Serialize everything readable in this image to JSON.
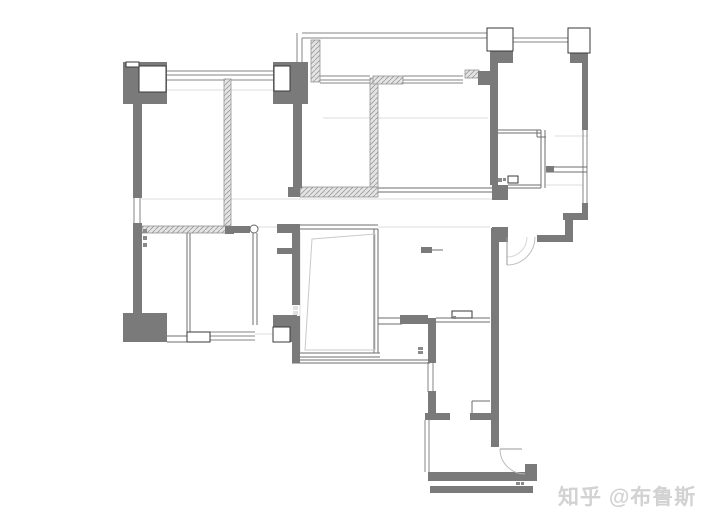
{
  "watermark": {
    "text": "知乎 @布鲁斯",
    "color": "#d2d2d2"
  },
  "canvas": {
    "width": 720,
    "height": 525,
    "background": "#ffffff"
  },
  "palette": {
    "wall": "#7a7a7a",
    "wall_outline": "#3a3a3a",
    "thin_wall": "#6e6e6e",
    "window": "#868686",
    "faint": "#dedede",
    "hatch_line": "#9a9a9a",
    "hatch_bg": "#e4e4e4",
    "arc": "#bbbbbb",
    "arc_light": "#d6d6d6",
    "furniture": "#c9c9c9",
    "mark": "#8a8a8a",
    "mark_light": "#e0e0e0"
  },
  "floorplan": {
    "faint_lines": [
      [
        142,
        199,
        492,
        199
      ],
      [
        142,
        227,
        298,
        227
      ],
      [
        378,
        227,
        490,
        227
      ],
      [
        167,
        90,
        273,
        90
      ],
      [
        323,
        118,
        488,
        118
      ],
      [
        546,
        185,
        583,
        185
      ],
      [
        555,
        136,
        588,
        136
      ],
      [
        300,
        232,
        300,
        352
      ],
      [
        255,
        334,
        273,
        334
      ]
    ],
    "window_lines": [
      [
        167,
        71,
        273,
        71
      ],
      [
        167,
        75,
        273,
        75
      ],
      [
        167,
        80,
        273,
        80
      ],
      [
        302,
        33,
        487,
        33
      ],
      [
        302,
        38,
        487,
        38
      ],
      [
        320,
        76,
        370,
        76
      ],
      [
        320,
        80,
        370,
        80
      ],
      [
        320,
        83,
        370,
        83
      ],
      [
        403,
        76,
        463,
        76
      ],
      [
        403,
        80,
        463,
        80
      ],
      [
        403,
        83,
        463,
        83
      ],
      [
        513,
        38,
        568,
        38
      ],
      [
        513,
        42,
        568,
        42
      ],
      [
        583,
        130,
        583,
        203
      ],
      [
        587,
        130,
        587,
        203
      ],
      [
        134,
        198,
        134,
        223
      ],
      [
        140,
        198,
        140,
        223
      ],
      [
        210,
        332,
        255,
        332
      ],
      [
        210,
        336,
        255,
        336
      ],
      [
        210,
        340,
        255,
        340
      ],
      [
        428,
        362,
        428,
        392
      ],
      [
        433,
        362,
        433,
        392
      ],
      [
        425,
        420,
        425,
        472
      ],
      [
        429,
        420,
        429,
        472
      ],
      [
        297,
        33,
        297,
        66
      ],
      [
        302,
        38,
        302,
        66
      ]
    ],
    "thin_lines": [
      [
        378,
        188,
        492,
        188
      ],
      [
        378,
        192,
        492,
        192
      ],
      [
        300,
        225,
        378,
        225
      ],
      [
        300,
        229,
        378,
        229
      ],
      [
        187,
        233,
        187,
        335
      ],
      [
        190,
        233,
        190,
        335
      ],
      [
        253,
        233,
        253,
        325
      ],
      [
        257,
        233,
        257,
        325
      ],
      [
        167,
        336,
        187,
        336
      ],
      [
        167,
        342,
        187,
        342
      ],
      [
        378,
        318,
        402,
        318
      ],
      [
        378,
        324,
        402,
        324
      ],
      [
        436,
        318,
        490,
        318
      ],
      [
        436,
        322,
        490,
        322
      ],
      [
        297,
        353,
        380,
        353
      ],
      [
        297,
        357,
        380,
        357
      ],
      [
        292,
        360,
        430,
        360
      ],
      [
        292,
        363,
        430,
        363
      ],
      [
        498,
        130,
        541,
        130
      ],
      [
        498,
        133,
        541,
        133
      ],
      [
        541,
        130,
        541,
        188
      ],
      [
        545,
        130,
        545,
        188
      ],
      [
        546,
        167,
        587,
        167
      ],
      [
        546,
        172,
        587,
        172
      ],
      [
        508,
        185,
        541,
        185
      ],
      [
        508,
        188,
        541,
        188
      ],
      [
        374,
        229,
        374,
        353
      ],
      [
        378,
        229,
        378,
        353
      ],
      [
        537,
        130,
        537,
        137
      ],
      [
        537,
        137,
        546,
        137
      ],
      [
        472,
        401,
        490,
        401
      ],
      [
        472,
        401,
        472,
        413
      ],
      [
        432,
        250,
        443,
        250
      ]
    ],
    "walls": [
      [
        123,
        62,
        44,
        42
      ],
      [
        273,
        62,
        35,
        42
      ],
      [
        133,
        104,
        9,
        94
      ],
      [
        133,
        223,
        9,
        90
      ],
      [
        123,
        313,
        44,
        29
      ],
      [
        293,
        66,
        9,
        122
      ],
      [
        288,
        187,
        12,
        10
      ],
      [
        292,
        228,
        8,
        77
      ],
      [
        292,
        316,
        8,
        47
      ],
      [
        277,
        224,
        23,
        9
      ],
      [
        233,
        226,
        17,
        7
      ],
      [
        225,
        226,
        9,
        8
      ],
      [
        273,
        315,
        24,
        12
      ],
      [
        290,
        315,
        7,
        27
      ],
      [
        421,
        247,
        11,
        6
      ],
      [
        277,
        248,
        15,
        6
      ],
      [
        400,
        315,
        28,
        9
      ],
      [
        428,
        318,
        8,
        45
      ],
      [
        428,
        391,
        8,
        29
      ],
      [
        491,
        228,
        8,
        219
      ],
      [
        425,
        413,
        25,
        7
      ],
      [
        470,
        413,
        21,
        7
      ],
      [
        428,
        472,
        105,
        9
      ],
      [
        430,
        486,
        103,
        7
      ],
      [
        525,
        464,
        12,
        17
      ],
      [
        492,
        227,
        16,
        15
      ],
      [
        492,
        185,
        16,
        15
      ],
      [
        490,
        50,
        8,
        135
      ],
      [
        582,
        53,
        6,
        77
      ],
      [
        582,
        203,
        6,
        12
      ],
      [
        563,
        213,
        25,
        7
      ],
      [
        565,
        220,
        8,
        17
      ],
      [
        537,
        235,
        36,
        7
      ],
      [
        492,
        50,
        21,
        13
      ],
      [
        570,
        52,
        18,
        11
      ],
      [
        546,
        166,
        8,
        6
      ],
      [
        478,
        71,
        12,
        14
      ]
    ],
    "hatch_walls": [
      [
        224,
        79,
        7,
        147
      ],
      [
        311,
        40,
        9,
        42
      ],
      [
        370,
        78,
        8,
        112
      ],
      [
        300,
        187,
        78,
        10
      ],
      [
        373,
        76,
        30,
        8
      ],
      [
        142,
        226,
        85,
        7
      ],
      [
        465,
        70,
        14,
        8
      ]
    ],
    "white_boxes": [
      [
        139,
        66,
        27,
        26
      ],
      [
        274,
        66,
        16,
        25
      ],
      [
        126,
        62,
        13,
        5
      ],
      [
        273,
        327,
        17,
        15
      ],
      [
        487,
        28,
        26,
        23
      ],
      [
        568,
        28,
        22,
        25
      ],
      [
        452,
        311,
        20,
        7
      ],
      [
        508,
        176,
        10,
        7
      ],
      [
        187,
        332,
        23,
        10
      ]
    ],
    "furniture_outline": [
      "M 312,239 L 375,234 L 375,350 L 305,350 Z"
    ],
    "door_arcs": [
      "M 535,237 A 28 28 0 0 1 507,265",
      "M 500,449 A 25 25 0 0 0 525,474"
    ],
    "door_arcs_light": [
      "M 527,237 A 20 20 0 0 1 507,257"
    ],
    "leaf_lines": [
      [
        507,
        237,
        507,
        265
      ],
      [
        500,
        449,
        522,
        449
      ]
    ],
    "nodes": [
      [
        254,
        229,
        4
      ]
    ],
    "marks": [
      [
        143,
        229,
        4,
        4
      ],
      [
        143,
        236,
        4,
        4
      ],
      [
        143,
        243,
        4,
        4
      ],
      [
        418,
        347,
        5,
        3
      ],
      [
        418,
        351,
        5,
        3
      ],
      [
        498,
        178,
        4,
        4
      ],
      [
        503,
        178,
        3,
        3
      ],
      [
        516,
        482,
        4,
        3
      ],
      [
        521,
        482,
        3,
        3
      ],
      [
        453,
        316,
        3,
        3
      ]
    ],
    "light_marks": [
      [
        293,
        306,
        5,
        4
      ],
      [
        293,
        311,
        5,
        4
      ]
    ]
  }
}
